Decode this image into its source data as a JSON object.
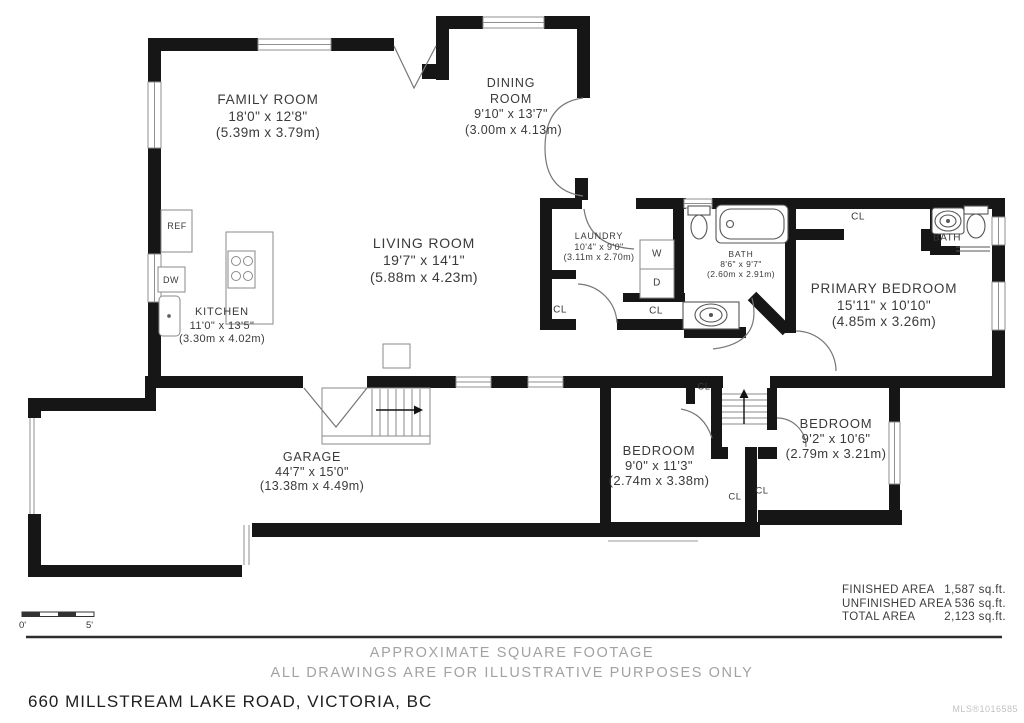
{
  "rooms": {
    "family": {
      "name": "FAMILY ROOM",
      "imperial": "18'0\" x 12'8\"",
      "metric": "(5.39m x 3.79m)"
    },
    "dining": {
      "name": "DINING ROOM",
      "imperial": "9'10\" x 13'7\"",
      "metric": "(3.00m x 4.13m)"
    },
    "living": {
      "name": "LIVING ROOM",
      "imperial": "19'7\" x 14'1\"",
      "metric": "(5.88m x 4.23m)"
    },
    "kitchen": {
      "name": "KITCHEN",
      "imperial": "11'0\" x 13'5\"",
      "metric": "(3.30m x 4.02m)"
    },
    "laundry": {
      "name": "LAUNDRY",
      "imperial": "10'4\" x 9'0\"",
      "metric": "(3.11m x 2.70m)"
    },
    "bath_main": {
      "name": "BATH",
      "imperial": "8'6\" x 9'7\"",
      "metric": "(2.60m x 2.91m)"
    },
    "bath_ensuite": {
      "name": "BATH"
    },
    "primary": {
      "name": "PRIMARY BEDROOM",
      "imperial": "15'11\" x 10'10\"",
      "metric": "(4.85m x 3.26m)"
    },
    "bedroom1": {
      "name": "BEDROOM",
      "imperial": "9'0\" x 11'3\"",
      "metric": "(2.74m x 3.38m)"
    },
    "bedroom2": {
      "name": "BEDROOM",
      "imperial": "9'2\" x 10'6\"",
      "metric": "(2.79m x 3.21m)"
    },
    "garage": {
      "name": "GARAGE",
      "imperial": "44'7\" x 15'0\"",
      "metric": "(13.38m x 4.49m)"
    }
  },
  "fixtures": {
    "ref": "REF",
    "dw": "DW",
    "washer": "W",
    "dryer": "D",
    "closet": "CL"
  },
  "areas": {
    "finished": {
      "label": "FINISHED AREA",
      "value": "1,587 sq.ft."
    },
    "unfinished": {
      "label": "UNFINISHED AREA",
      "value": "536 sq.ft."
    },
    "total": {
      "label": "TOTAL AREA",
      "value": "2,123 sq.ft."
    }
  },
  "disclaimer": {
    "line1": "APPROXIMATE SQUARE FOOTAGE",
    "line2": "ALL DRAWINGS ARE FOR ILLUSTRATIVE PURPOSES ONLY"
  },
  "footer": {
    "address": "660 MILLSTREAM LAKE ROAD, VICTORIA, BC",
    "mls": "MLS®1016585"
  },
  "scale": {
    "start": "0'",
    "end": "5'"
  },
  "colors": {
    "wall": "#161616",
    "text": "#3a3a3a",
    "muted": "#a2a2a2"
  }
}
